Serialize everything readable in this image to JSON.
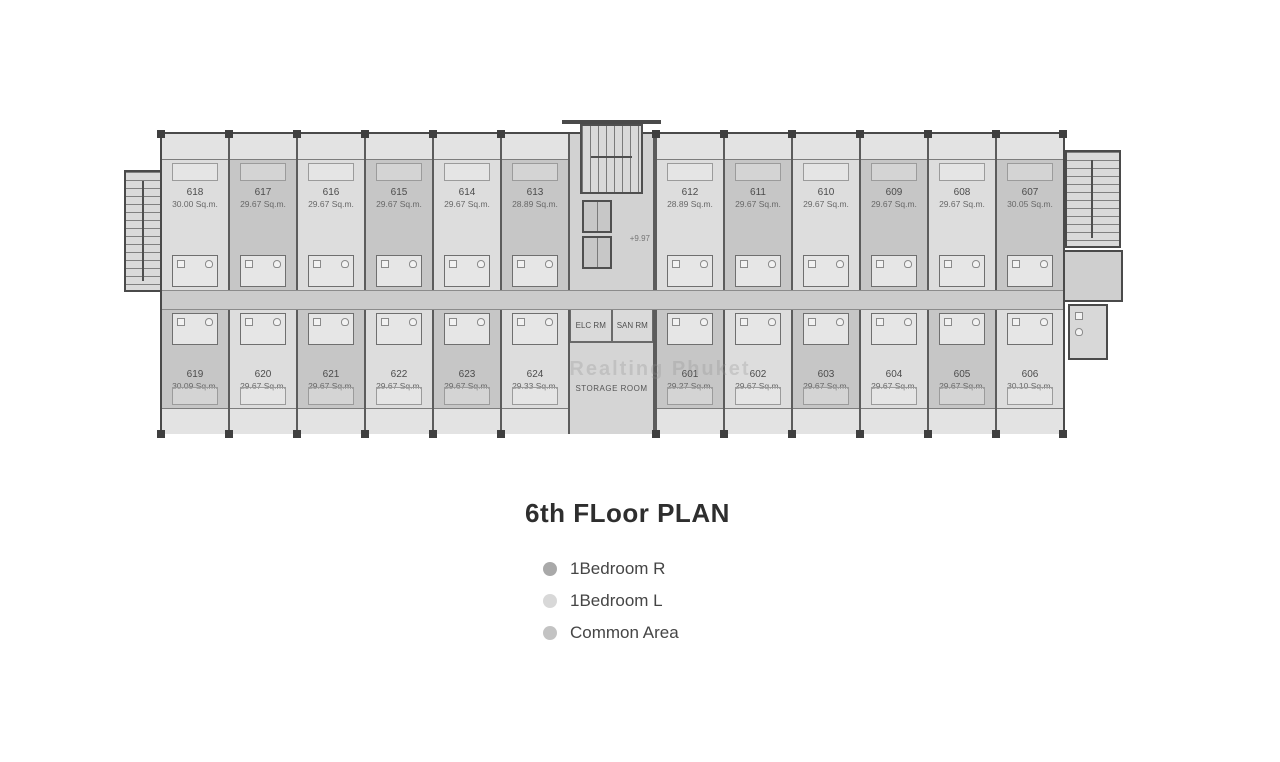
{
  "title": "6th FLoor PLAN",
  "legend": [
    {
      "label": "1Bedroom R",
      "color": "#a9a9a9"
    },
    {
      "label": "1Bedroom L",
      "color": "#d8d8d8"
    },
    {
      "label": "Common Area",
      "color": "#c3c3c3"
    }
  ],
  "floor_plan": {
    "level_marker": "+9.97",
    "core_rooms": {
      "elc": "ELC RM",
      "san": "SAN RM",
      "storage": "STORAGE ROOM"
    },
    "watermark": "Realting Phuket",
    "unit_colors": {
      "1Bedroom R": "#c6c6c6",
      "1Bedroom L": "#dddddd"
    },
    "common_color": "#cbcbcb",
    "top_row": [
      {
        "number": "618",
        "area": "30.00 Sq.m.",
        "type": "1Bedroom L"
      },
      {
        "number": "617",
        "area": "29.67 Sq.m.",
        "type": "1Bedroom R"
      },
      {
        "number": "616",
        "area": "29.67 Sq.m.",
        "type": "1Bedroom L"
      },
      {
        "number": "615",
        "area": "29.67 Sq.m.",
        "type": "1Bedroom R"
      },
      {
        "number": "614",
        "area": "29.67 Sq.m.",
        "type": "1Bedroom L"
      },
      {
        "number": "613",
        "area": "28.89 Sq.m.",
        "type": "1Bedroom R"
      },
      {
        "number": "612",
        "area": "28.89 Sq.m.",
        "type": "1Bedroom L"
      },
      {
        "number": "611",
        "area": "29.67 Sq.m.",
        "type": "1Bedroom R"
      },
      {
        "number": "610",
        "area": "29.67 Sq.m.",
        "type": "1Bedroom L"
      },
      {
        "number": "609",
        "area": "29.67 Sq.m.",
        "type": "1Bedroom R"
      },
      {
        "number": "608",
        "area": "29.67 Sq.m.",
        "type": "1Bedroom L"
      },
      {
        "number": "607",
        "area": "30.05 Sq.m.",
        "type": "1Bedroom R"
      }
    ],
    "bottom_row": [
      {
        "number": "619",
        "area": "30.09 Sq.m.",
        "type": "1Bedroom R"
      },
      {
        "number": "620",
        "area": "29.67 Sq.m.",
        "type": "1Bedroom L"
      },
      {
        "number": "621",
        "area": "29.67 Sq.m.",
        "type": "1Bedroom R"
      },
      {
        "number": "622",
        "area": "29.67 Sq.m.",
        "type": "1Bedroom L"
      },
      {
        "number": "623",
        "area": "29.67 Sq.m.",
        "type": "1Bedroom R"
      },
      {
        "number": "624",
        "area": "29.33 Sq.m.",
        "type": "1Bedroom L"
      },
      {
        "number": "601",
        "area": "29.27 Sq.m.",
        "type": "1Bedroom R"
      },
      {
        "number": "602",
        "area": "29.67 Sq.m.",
        "type": "1Bedroom L"
      },
      {
        "number": "603",
        "area": "29.67 Sq.m.",
        "type": "1Bedroom R"
      },
      {
        "number": "604",
        "area": "29.67 Sq.m.",
        "type": "1Bedroom L"
      },
      {
        "number": "605",
        "area": "29.67 Sq.m.",
        "type": "1Bedroom R"
      },
      {
        "number": "606",
        "area": "30.10 Sq.m.",
        "type": "1Bedroom L"
      }
    ]
  }
}
